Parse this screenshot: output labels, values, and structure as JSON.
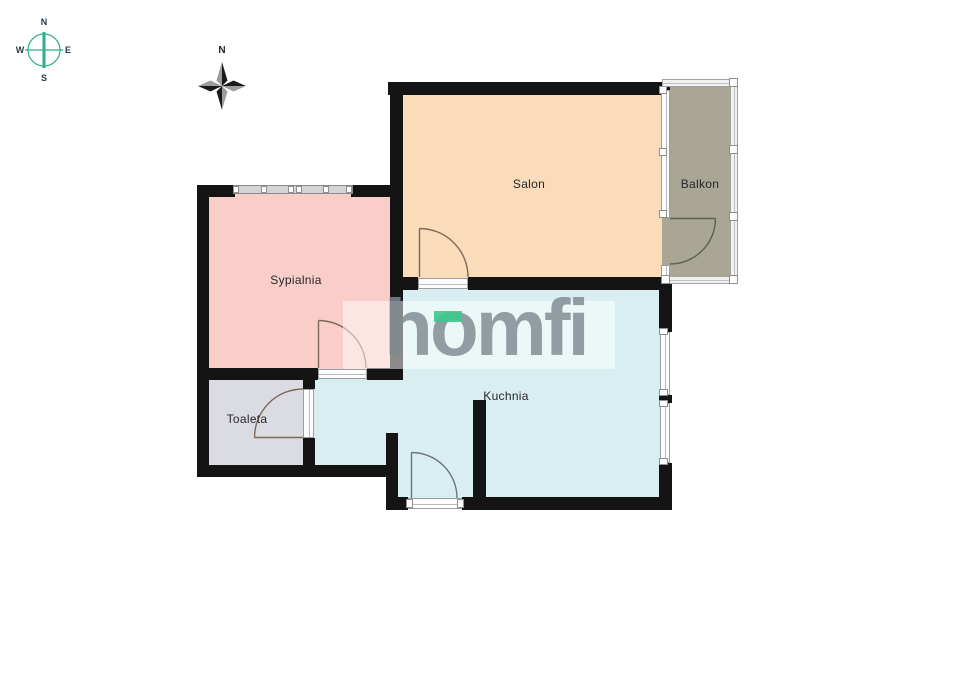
{
  "title": "Apartment floor plan",
  "rooms": [
    {
      "id": "salon",
      "label": "Salon"
    },
    {
      "id": "balkon",
      "label": "Balkon"
    },
    {
      "id": "sypialnia",
      "label": "Sypialnia"
    },
    {
      "id": "kuchnia",
      "label": "Kuchnia"
    },
    {
      "id": "toaleta",
      "label": "Toaleta"
    }
  ],
  "watermark": {
    "text": "homfi"
  },
  "compass_rose": {
    "n": "N",
    "e": "E",
    "s": "S",
    "w": "W"
  },
  "compass_star": {
    "n": "N"
  },
  "colors": {
    "salon": "#FADCBA",
    "balkon": "#A9A694",
    "sypialnia": "#F9CDC8",
    "kuchnia": "#D8EEF1",
    "toaleta": "#DBDBE3",
    "wall": "#141414",
    "accent-green": "#3EC98E",
    "logo-gray": "#7E8A90",
    "compass-teal": "#2EAE8C"
  }
}
